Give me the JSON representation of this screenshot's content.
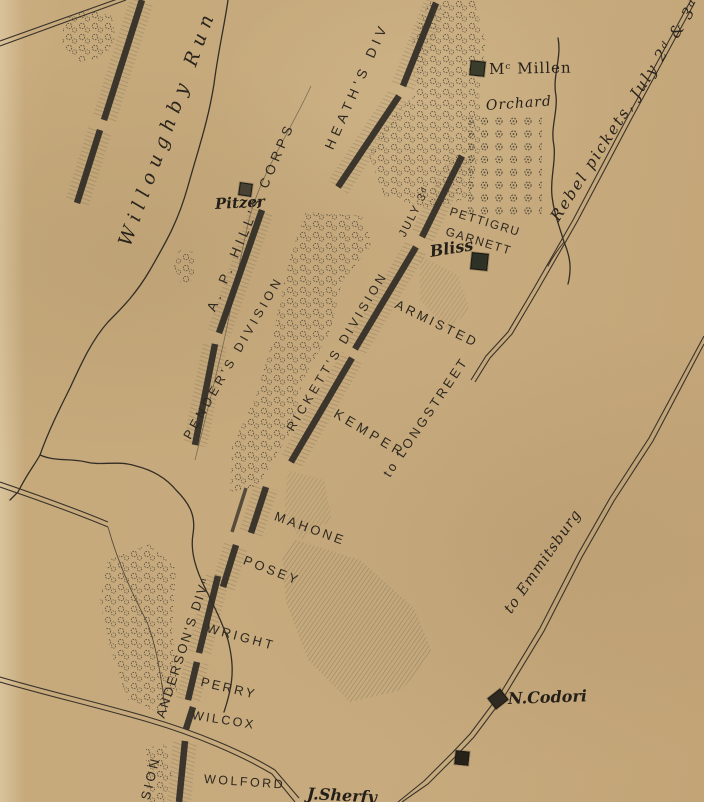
{
  "map": {
    "description_of_view": "hand-drawn sepia battlefield map sheet",
    "colors": {
      "paper": "#c6aa7c",
      "ink": "#2e2820",
      "line_work": "#3a322a"
    },
    "icons": {
      "house": "small dark filled square",
      "tree": "dashed scribble circle",
      "road": "double parallel line",
      "stream": "wavy line",
      "battle_line": "thick dark bar"
    }
  },
  "labels": {
    "willoughby_run": "Willoughby Run",
    "ap_hills_corps": "A. P. HILL'S CORPS",
    "heaths_div": "HEATH'S DIV",
    "penders_division": "PENDER'S DIVISION",
    "ricketts_division": "RICKETT'S DIVISION",
    "july_3d": "JULY 3ᵈ",
    "pettigru": "PETTIGRU",
    "garnett": "GARNETT",
    "armisted": "ARMISTED",
    "kemper": "KEMPER",
    "to_longstreet": "to LONGSTREET",
    "mahone": "MAHONE",
    "posey": "POSEY",
    "wright": "WRIGHT",
    "perry": "PERRY",
    "wilcox": "WILCOX",
    "wolford": "WOLFORD",
    "andersons_divn": "ANDERSON'S DIVⁿ",
    "sion": "SION",
    "rebel_pickets": "Rebel pickets, July 2ᵈ & 3ᵈ",
    "to_emmitsburg": "to Emmitsburg",
    "mcmillen": "Mᶜ Millen",
    "orchard": "Orchard",
    "bliss": "Bliss",
    "pitzer": "Pitzer",
    "n_codori": "N.Codori",
    "j_sherfy": "J.Sherfy"
  }
}
